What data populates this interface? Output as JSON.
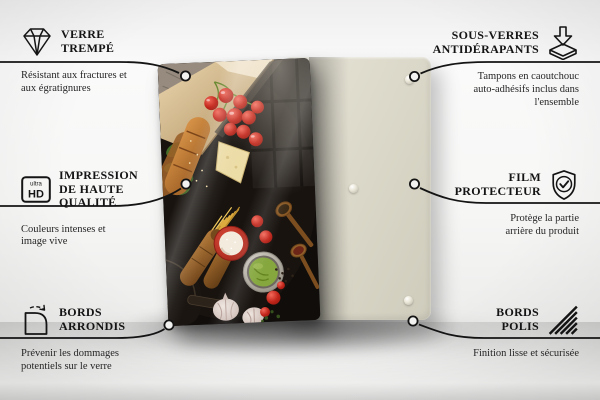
{
  "callouts": {
    "verre_trempe": {
      "title": "VERRE TREMPÉ",
      "desc": "Résistant aux fractures et aux égratignures",
      "icon": "diamond-icon"
    },
    "sous_verres": {
      "title": "SOUS-VERRES ANTIDÉRAPANTS",
      "desc": "Tampons en caoutchouc auto-adhésifs inclus dans l'ensemble",
      "icon": "arrow-down-pad-icon"
    },
    "impression": {
      "title": "IMPRESSION DE HAUTE QUALITÉ",
      "desc": "Couleurs intenses et image vive",
      "icon": "ultra-hd-icon"
    },
    "film_protecteur": {
      "title": "FILM PROTECTEUR",
      "desc": "Protège la partie arrière du produit",
      "icon": "shield-check-icon"
    },
    "bords_arrondis": {
      "title": "BORDS ARRONDIS",
      "desc": "Prévenir les dommages potentiels sur le verre",
      "icon": "rounded-corner-icon"
    },
    "bords_polis": {
      "title": "BORDS POLIS",
      "desc": "Finition lisse et sécurisée",
      "icon": "polished-edge-icon"
    }
  },
  "icon_labels": {
    "ultra": "ultra",
    "hd": "HD"
  },
  "product": {
    "front_panel": "glass-panel-with-food-print",
    "back_panel": "beige-backing-panel",
    "pads_visible": 3
  },
  "colors": {
    "line": "#141414",
    "back_panel": "#dcd9ca",
    "glass_bg": "#100d0b",
    "tomato_red": "#c1251a",
    "pesto_green": "#85a73e",
    "bowl_red": "#c3302a"
  }
}
